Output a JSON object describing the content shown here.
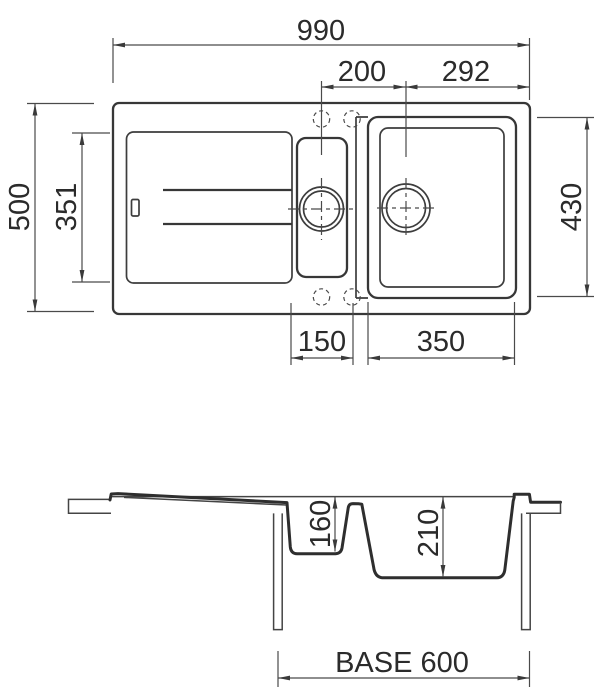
{
  "drawing": {
    "background": "#ffffff",
    "line_color": "#3a3a3a",
    "dim_color": "#4a4a4a",
    "text_color": "#2b2b2b",
    "units": "mm"
  },
  "top_view": {
    "dims": {
      "overall_width": "990",
      "drain_spacing": "200",
      "drain_to_edge": "292",
      "overall_depth": "500",
      "drainboard_depth": "351",
      "main_bowl_outer_depth": "430",
      "half_bowl_width": "150",
      "main_bowl_width": "350"
    }
  },
  "section_view": {
    "dims": {
      "half_bowl_depth": "160",
      "main_bowl_depth": "210",
      "base_cabinet": "BASE 600"
    }
  }
}
